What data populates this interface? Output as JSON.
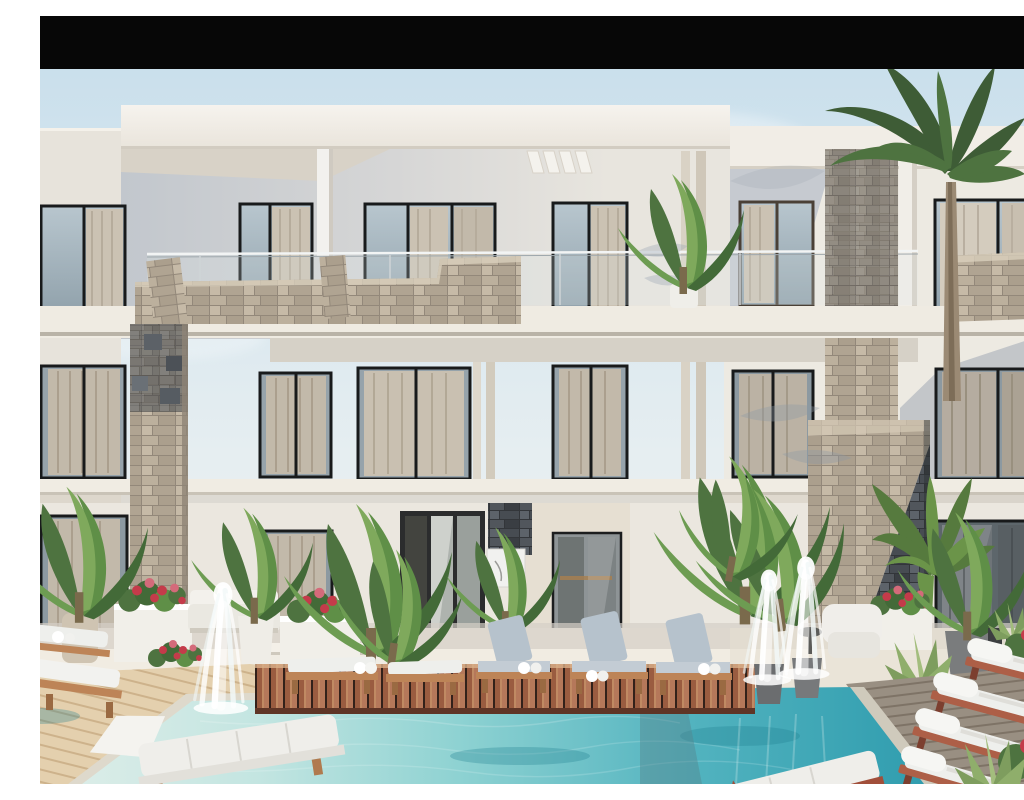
{
  "scene": {
    "domain": "Natural-Image",
    "description": "3D architectural rendering of a modern white three-storey residential building with dark-framed windows and sheer curtains, travertine stone-clad columns and balcony parapets, glass balustrades, palm trees and tropical planters with red flowers, a turquoise swimming pool with white cascade fountains, reddish and pale wooden decks, and rows of white sun loungers. A black letterbox bar runs across the top of the frame.",
    "elements": {
      "top_bar": "black letterbox bar",
      "sky": "pale blue sky with faint clouds",
      "building": "modern white apartment facade, three visible levels",
      "balcony": "second-floor balcony with glass railing and stone parapet",
      "stone_accents": "travertine and dark slate stone cladding",
      "entrance": "dark-framed glass entrance doors with doormat and wall art",
      "windows": "floor-to-ceiling windows with beige curtains",
      "palms": "tall palm tree above the roof and a lower fan palm",
      "planters": "white planter boxes with red and pink flowers",
      "pool": "turquoise swimming pool with stone coping",
      "fountains": "three white cascade fountains",
      "decks": "red hardwood deck platform, pale plank deck, grey weathered deck",
      "loungers": "white and pale-blue cushioned sun loungers with towel rolls",
      "chaises": "large white chaise lounges in the foreground"
    },
    "palette": {
      "bar_black": "#070707",
      "sky_top": "#c9dfec",
      "sky_bottom": "#f2f4f3",
      "fascia_white": "#f4f1eb",
      "wall_light": "#ebe7df",
      "wall_shadow": "#c7cbd1",
      "slab": "#efebe2",
      "stone_travertine": "#b3a795",
      "stone_slate": "#44484d",
      "window_frame": "#181a1b",
      "glass_sky": "#b8c6ce",
      "curtain": "#cbc2b3",
      "pool_deep": "#2f9cae",
      "pool_light": "#dcede8",
      "deck_red": "#a4644a",
      "deck_pale": "#e4d0ae",
      "deck_gray": "#998f82",
      "cushion_white": "#eeefec",
      "cushion_blue": "#b6c2cc",
      "wood_frame": "#bd8457",
      "terracotta": "#ad5f47",
      "leaf_dark": "#2f4929",
      "leaf_mid": "#4e7340",
      "leaf_light": "#7fa95c",
      "flower_red": "#c43b4a",
      "flower_pink": "#d46a7a",
      "fountain_white": "#ffffff"
    }
  }
}
